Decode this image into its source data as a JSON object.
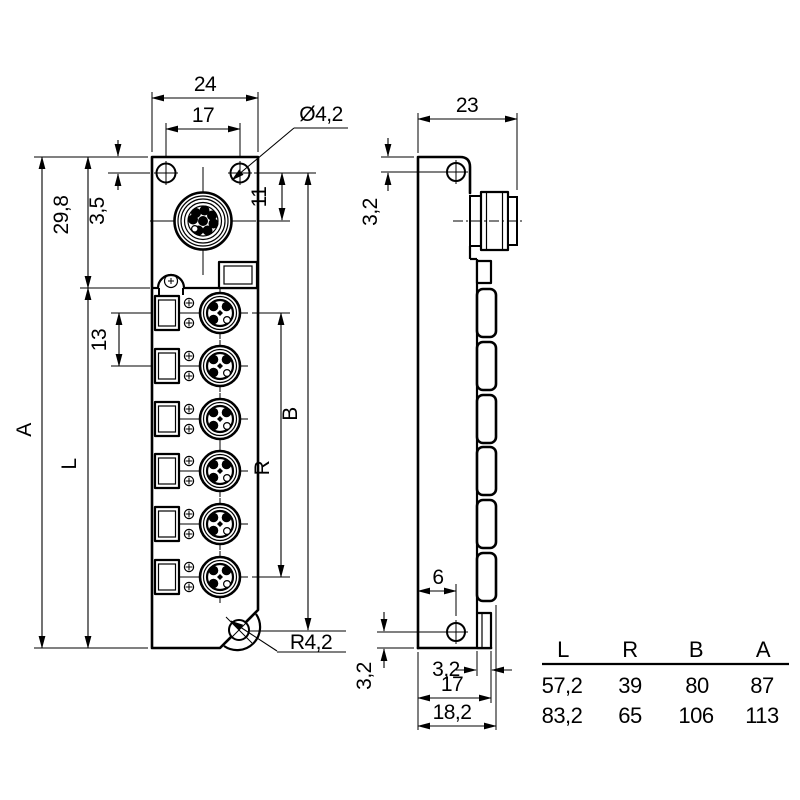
{
  "front_view": {
    "width": "24",
    "hole_spacing": "17",
    "hole_diameter": "Ø4,2",
    "hole_top_offset": "3,5",
    "head_height": "29,8",
    "total_height": "A",
    "body_height": "L",
    "port_pitch": "13",
    "m12_offset": "11",
    "hole_span": "B",
    "port_span": "R",
    "corner_radius": "R4,2"
  },
  "side_view": {
    "depth": "23",
    "top_hole_offset": "3,2",
    "bottom_hole_inset": "6",
    "bottom_hole_offset": "3,2",
    "flange_depth": "3,2",
    "body_depth": "17",
    "total_depth": "18,2"
  },
  "dimension_table": {
    "headers": [
      "L",
      "R",
      "B",
      "A"
    ],
    "rows": [
      [
        "57,2",
        "39",
        "80",
        "87"
      ],
      [
        "83,2",
        "65",
        "106",
        "113"
      ]
    ]
  }
}
